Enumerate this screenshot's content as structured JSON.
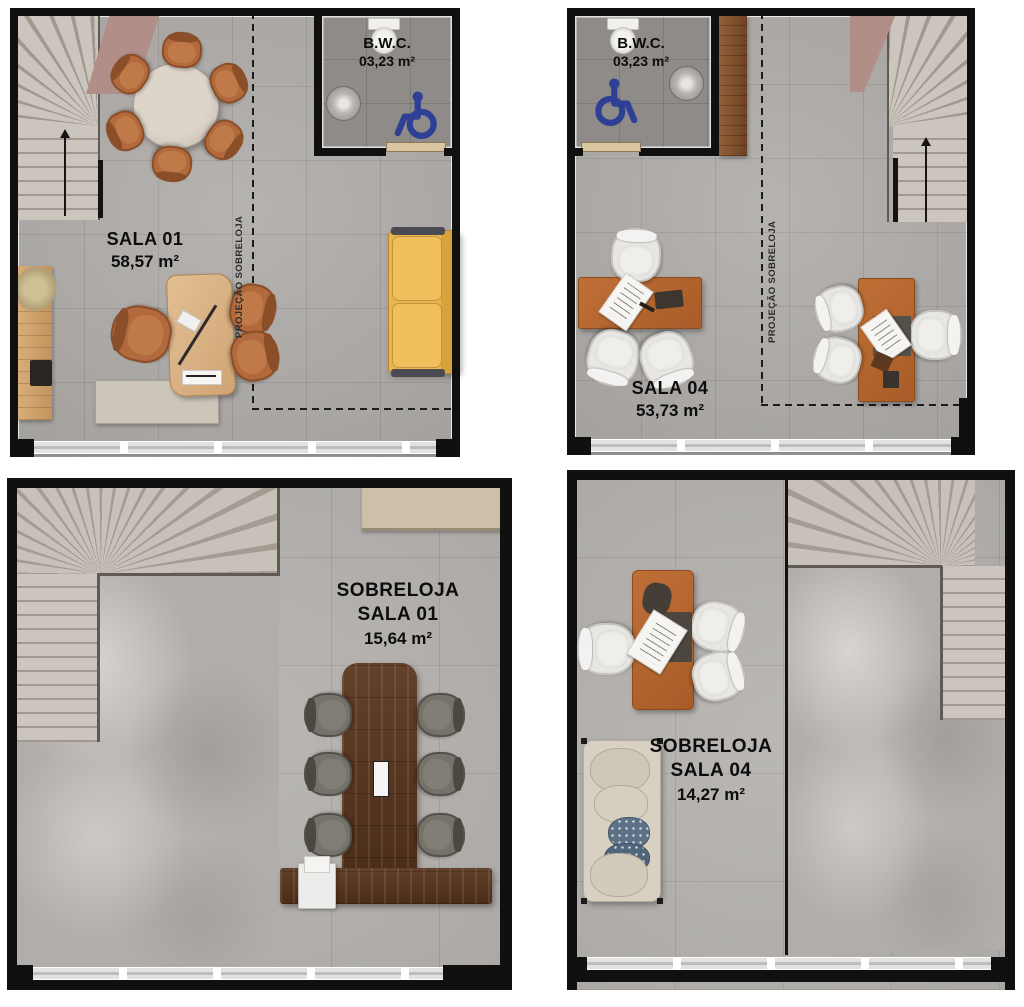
{
  "document": {
    "type": "floor-plan-sheet",
    "background": "#ffffff"
  },
  "colors": {
    "wall": "#101010",
    "floor_tile": "#adaaa7",
    "bwc_floor": "#8e8b88",
    "accessibility_blue": "#2e3f96",
    "sofa_yellow": "#e9b64e",
    "desk_orange": "#b5662f",
    "conference_table_walnut": "#57361f",
    "ramp_mauve": "#b18e87",
    "label_text": "#0d0d0d"
  },
  "plans": {
    "sala01": {
      "name": "SALA 01",
      "area": "58,57 m²",
      "projection_label": "PROJEÇÃO SOBRELOJA",
      "bwc": {
        "label": "B.W.C.",
        "area": "03,23 m²"
      }
    },
    "sala04": {
      "name": "SALA 04",
      "area": "53,73 m²",
      "projection_label": "PROJEÇÃO SOBRELOJA",
      "bwc": {
        "label": "B.W.C.",
        "area": "03,23 m²"
      }
    },
    "sobreloja_sala01": {
      "prefix": "SOBRELOJA",
      "name": "SALA 01",
      "area": "15,64 m²"
    },
    "sobreloja_sala04": {
      "prefix": "SOBRELOJA",
      "name": "SALA 04",
      "area": "14,27 m²"
    }
  },
  "icons": {
    "wheelchair": "wheelchair-accessibility-icon",
    "stair_arrow": "stair-direction-up-arrow"
  }
}
